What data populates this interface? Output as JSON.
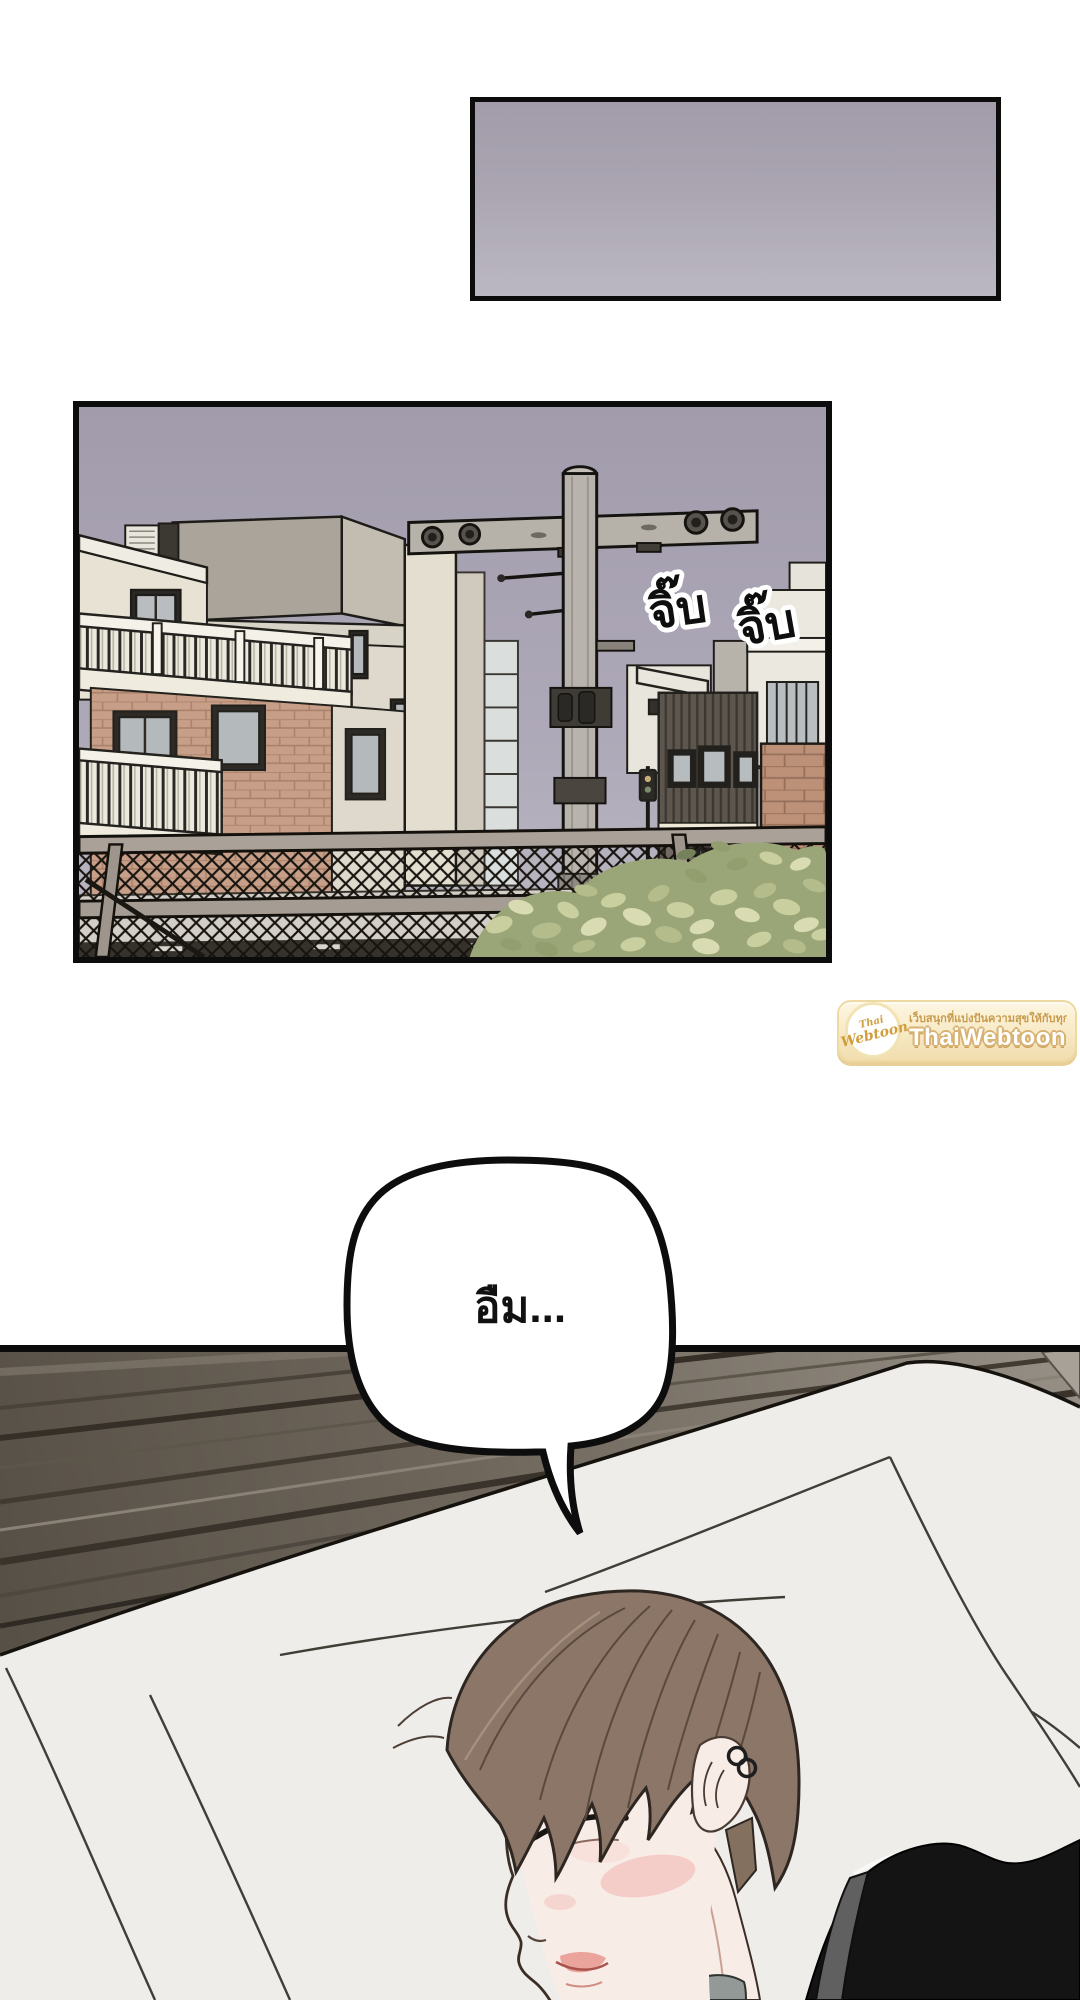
{
  "page": {
    "background": "#ffffff"
  },
  "sky_panel": {
    "top_color": "#a29caa",
    "bottom_color": "#bcb8c3"
  },
  "city_panel": {
    "sky_top": "#a19bab",
    "sky_bottom": "#bcb8c3",
    "sfx": [
      {
        "text": "จิ๊บ"
      },
      {
        "text": "จิ๊บ"
      }
    ],
    "shop_sign_text": "nthraside"
  },
  "bedroom_panel": {
    "speech": {
      "text": "อืม..."
    }
  },
  "watermark": {
    "tagline": "เว็บสนุกที่แบ่งปันความสุขให้กับทุกคน",
    "site_name": "ThaiWebtoon",
    "logo_top": "Thai",
    "logo_bottom": "Webtoon",
    "accent_color": "#d8b273"
  }
}
